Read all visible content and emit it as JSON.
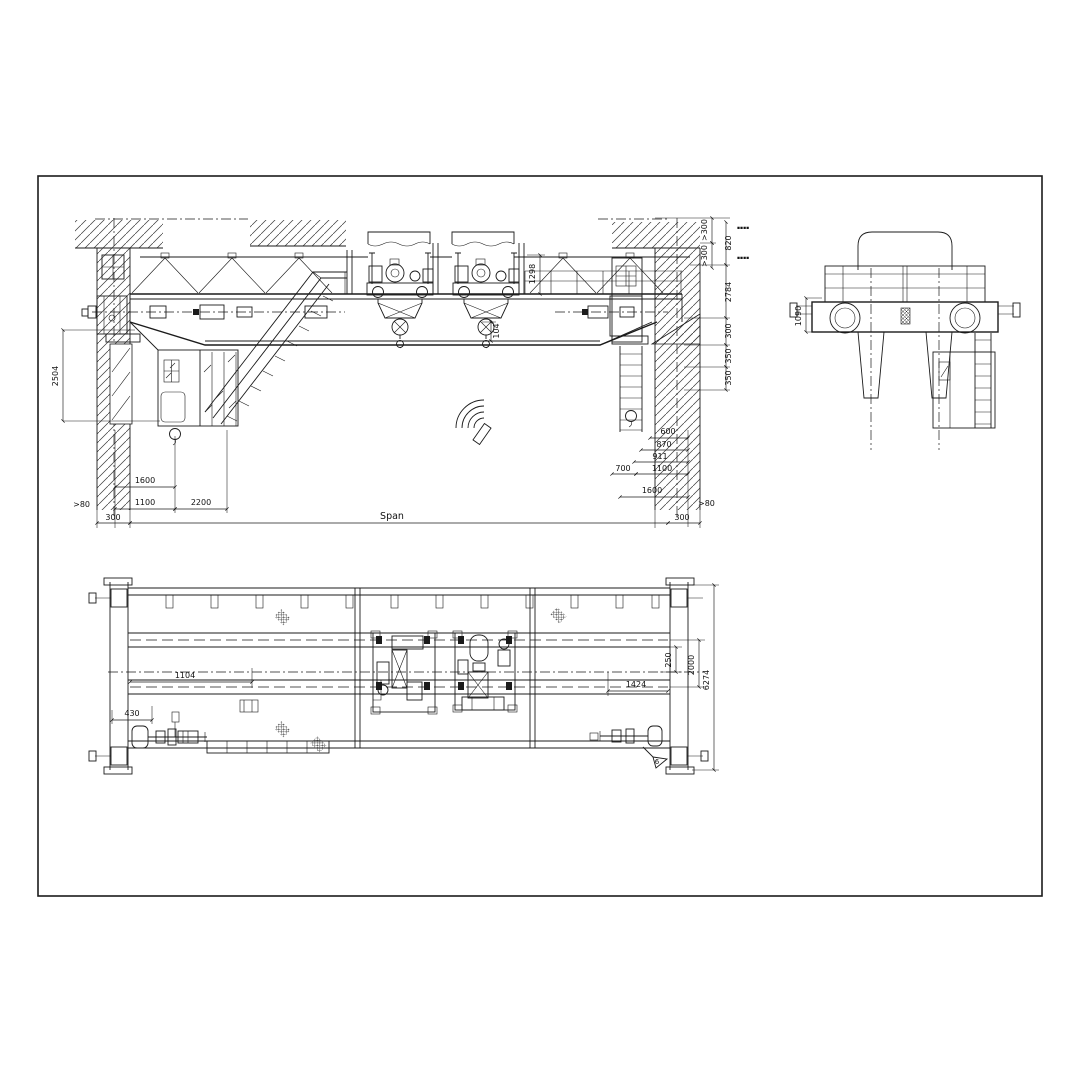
{
  "dims": {
    "front": {
      "col_height": "2504",
      "clear_left": ">80",
      "end_300_left": "300",
      "c1600": "1600",
      "c1100": "1100",
      "c2200": "2200",
      "span": "Span",
      "end_300_right": "300",
      "clear_right": ">80",
      "hook_clear": "104",
      "truss_height": "1298",
      "top_clear_a": ">300",
      "top_clear_b": ">300",
      "roof_clear": "820",
      "rail_height": "2784",
      "v300": "300",
      "v350a": "350",
      "v350b": "350",
      "b600": "600",
      "b870": "870",
      "b911": "911",
      "b700": "700",
      "b1100": "1100",
      "b1600": "1600",
      "note_a": "▪▪▪▪",
      "note_b": "▪▪▪▪"
    },
    "side": {
      "girder_height": "1090"
    },
    "plan": {
      "w1104": "1104",
      "w430": "430",
      "w1424": "1424",
      "w250": "250",
      "gauge": "2000",
      "overall": "6274",
      "section_marker": "6"
    }
  }
}
